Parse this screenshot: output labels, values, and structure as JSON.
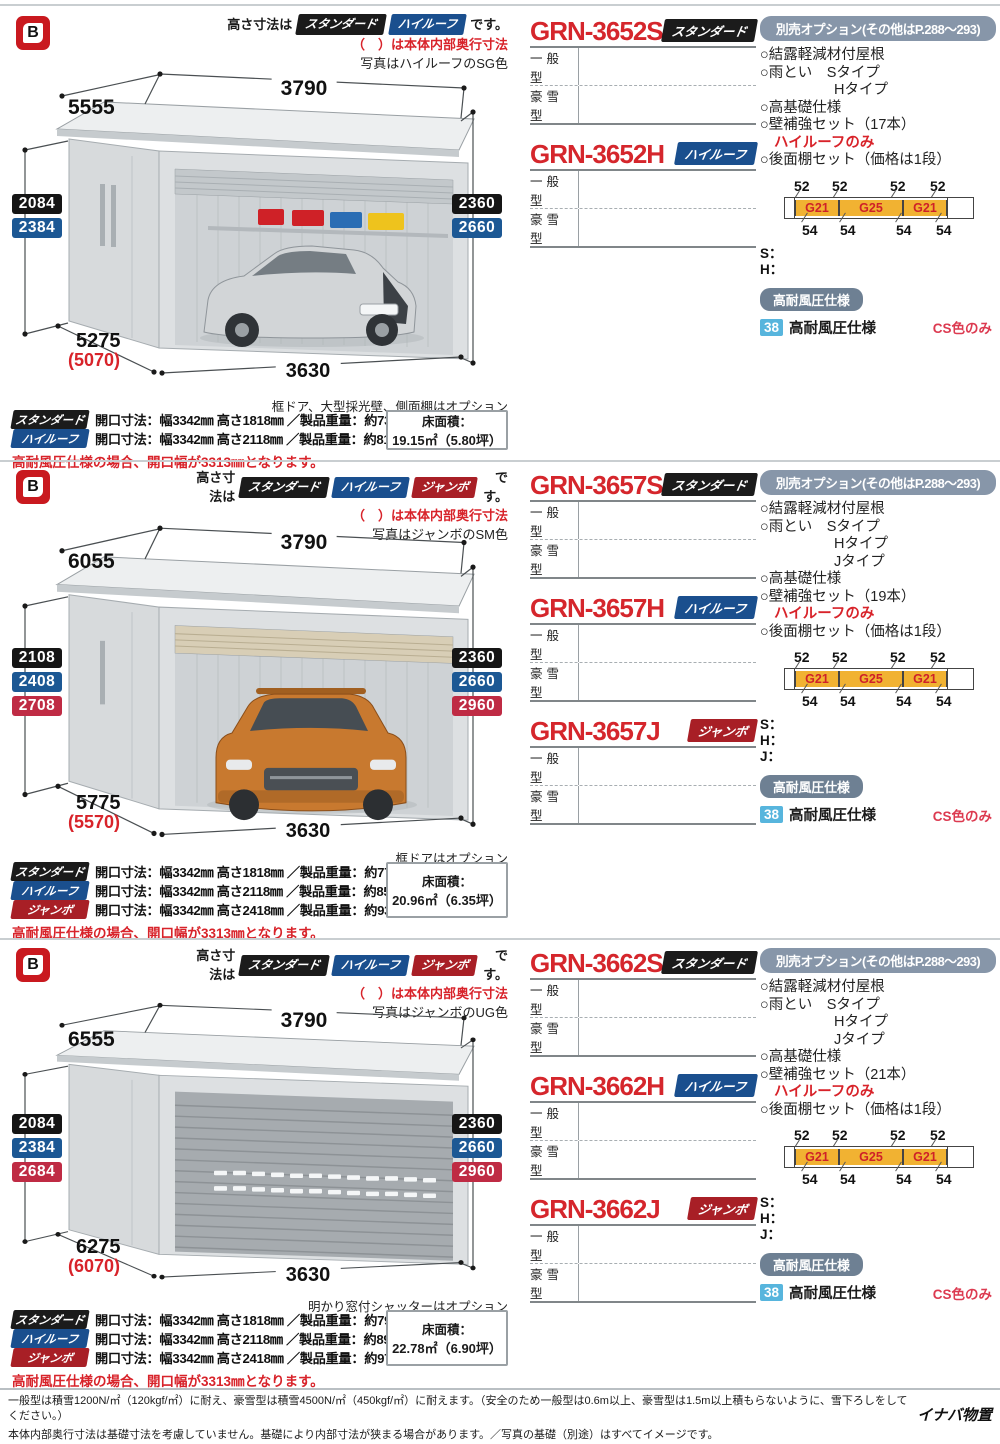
{
  "brand": {
    "icon_letter": "B"
  },
  "badges": {
    "standard": "スタンダード",
    "highroof": "ハイルーフ",
    "jumbo": "ジャンボ"
  },
  "common": {
    "size_note_prefix": "高さ寸法は",
    "size_note_suffix": "です。",
    "paren_note": "（　）は本体内部奥行寸法",
    "general_label": "一般型",
    "snow_label": "豪雪型",
    "floor_label": "床面積：",
    "options_header": "別売オプション(その他はP.288～293)",
    "opt_roof": "○結露軽減材付屋根",
    "opt_gutter": "○雨とい　Sタイプ",
    "opt_gutter_h": "Hタイプ",
    "opt_gutter_j": "Jタイプ",
    "opt_foundation": "○高基礎仕様",
    "opt_shelf": "○後面棚セット（価格は1段）",
    "highroof_only": "ハイルーフのみ",
    "shelf_top": [
      "52",
      "52",
      "52",
      "52"
    ],
    "shelf_mid": [
      "G21",
      "G25",
      "G21"
    ],
    "shelf_bottom": [
      "54",
      "54",
      "54",
      "54"
    ],
    "line_s": "S：",
    "line_h": "H：",
    "line_j": "J：",
    "wind_header": "高耐風圧仕様",
    "wind_page": "38",
    "wind_label": "高耐風圧仕様",
    "cs_note": "CS色のみ",
    "opening_note": "高耐風圧仕様の場合、開口幅が3313㎜となります。"
  },
  "sections": [
    {
      "photo_note": "写真はハイルーフのSG色",
      "wall_item": "○壁補強セット（17本）",
      "dims": {
        "top_width": "3790",
        "top_depth": "5555",
        "left": [
          "2084",
          "2384"
        ],
        "right": [
          "2360",
          "2660"
        ],
        "bottom_depth": "5275",
        "bottom_depth_inner": "(5070)",
        "bottom_width": "3630"
      },
      "caption": "框ドア、大型採光壁、側面棚はオプション",
      "models": [
        {
          "name": "GRN-3652S"
        },
        {
          "name": "GRN-3652H"
        }
      ],
      "specs": [
        {
          "text": "開口寸法：幅3342㎜ 高さ1818㎜ ／製品重量：約734kg"
        },
        {
          "text": "開口寸法：幅3342㎜ 高さ2118㎜ ／製品重量：約818kg"
        }
      ],
      "floor_area": "19.15㎡（5.80坪）"
    },
    {
      "photo_note": "写真はジャンボのSM色",
      "wall_item": "○壁補強セット（19本）",
      "dims": {
        "top_width": "3790",
        "top_depth": "6055",
        "left": [
          "2108",
          "2408",
          "2708"
        ],
        "right": [
          "2360",
          "2660",
          "2960"
        ],
        "bottom_depth": "5775",
        "bottom_depth_inner": "(5570)",
        "bottom_width": "3630"
      },
      "caption": "框ドアはオプション",
      "models": [
        {
          "name": "GRN-3657S"
        },
        {
          "name": "GRN-3657H"
        },
        {
          "name": "GRN-3657J"
        }
      ],
      "specs": [
        {
          "text": "開口寸法：幅3342㎜ 高さ1818㎜ ／製品重量：約770kg"
        },
        {
          "text": "開口寸法：幅3342㎜ 高さ2118㎜ ／製品重量：約858kg"
        },
        {
          "text": "開口寸法：幅3342㎜ 高さ2418㎜ ／製品重量：約934kg"
        }
      ],
      "floor_area": "20.96㎡（6.35坪）"
    },
    {
      "photo_note": "写真はジャンボのUG色",
      "wall_item": "○壁補強セット（21本）",
      "dims": {
        "top_width": "3790",
        "top_depth": "6555",
        "left": [
          "2084",
          "2384",
          "2684"
        ],
        "right": [
          "2360",
          "2660",
          "2960"
        ],
        "bottom_depth": "6275",
        "bottom_depth_inner": "(6070)",
        "bottom_width": "3630"
      },
      "caption": "明かり窓付シャッターはオプション",
      "models": [
        {
          "name": "GRN-3662S"
        },
        {
          "name": "GRN-3662H"
        },
        {
          "name": "GRN-3662J"
        }
      ],
      "specs": [
        {
          "text": "開口寸法：幅3342㎜ 高さ1818㎜ ／製品重量：約797kg"
        },
        {
          "text": "開口寸法：幅3342㎜ 高さ2118㎜ ／製品重量：約890kg"
        },
        {
          "text": "開口寸法：幅3342㎜ 高さ2418㎜ ／製品重量：約971kg"
        }
      ],
      "floor_area": "22.78㎡（6.90坪）"
    }
  ],
  "footer": {
    "line1": "一般型は積雪1200N/㎡（120kgf/㎡）に耐え、豪雪型は積雪4500N/㎡（450kgf/㎡）に耐えます。（安全のため一般型は0.6m以上、豪雪型は1.5m以上積もらないように、雪下ろしをしてください。）",
    "line2": "本体内部奥行寸法は基礎寸法を考慮していません。基礎により内部寸法が狭まる場合があります。／写真の基礎（別途）はすべてイメージです。",
    "brand": "イナバ物置"
  }
}
